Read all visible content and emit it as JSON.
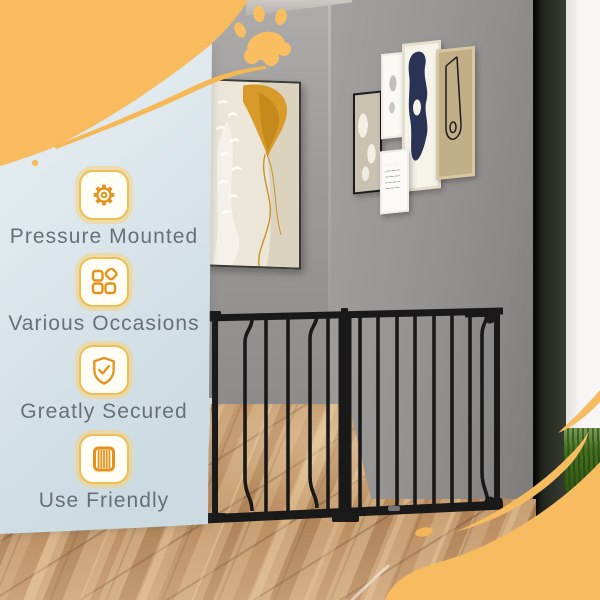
{
  "overlay": {
    "features": [
      {
        "icon": "gear-icon",
        "label": "Pressure Mounted"
      },
      {
        "icon": "shapes-icon",
        "label": "Various Occasions"
      },
      {
        "icon": "shield-check-icon",
        "label": "Greatly Secured"
      },
      {
        "icon": "fence-icon",
        "label": "Use Friendly"
      }
    ]
  },
  "scene": {
    "subject": "black metal pressure-mounted pet safety gate across a hallway",
    "decorations": [
      "paw-print",
      "yellow-swirl-top-left",
      "yellow-swirl-bottom-right"
    ]
  },
  "colors": {
    "accent_yellow": "#F8BC5E",
    "icon_orange": "#E5921D",
    "panel_blue_top": "#E7EFF2",
    "panel_blue_bottom": "#CDDBE3",
    "label_gray": "#687077",
    "gate_black": "#1A1A1A"
  }
}
